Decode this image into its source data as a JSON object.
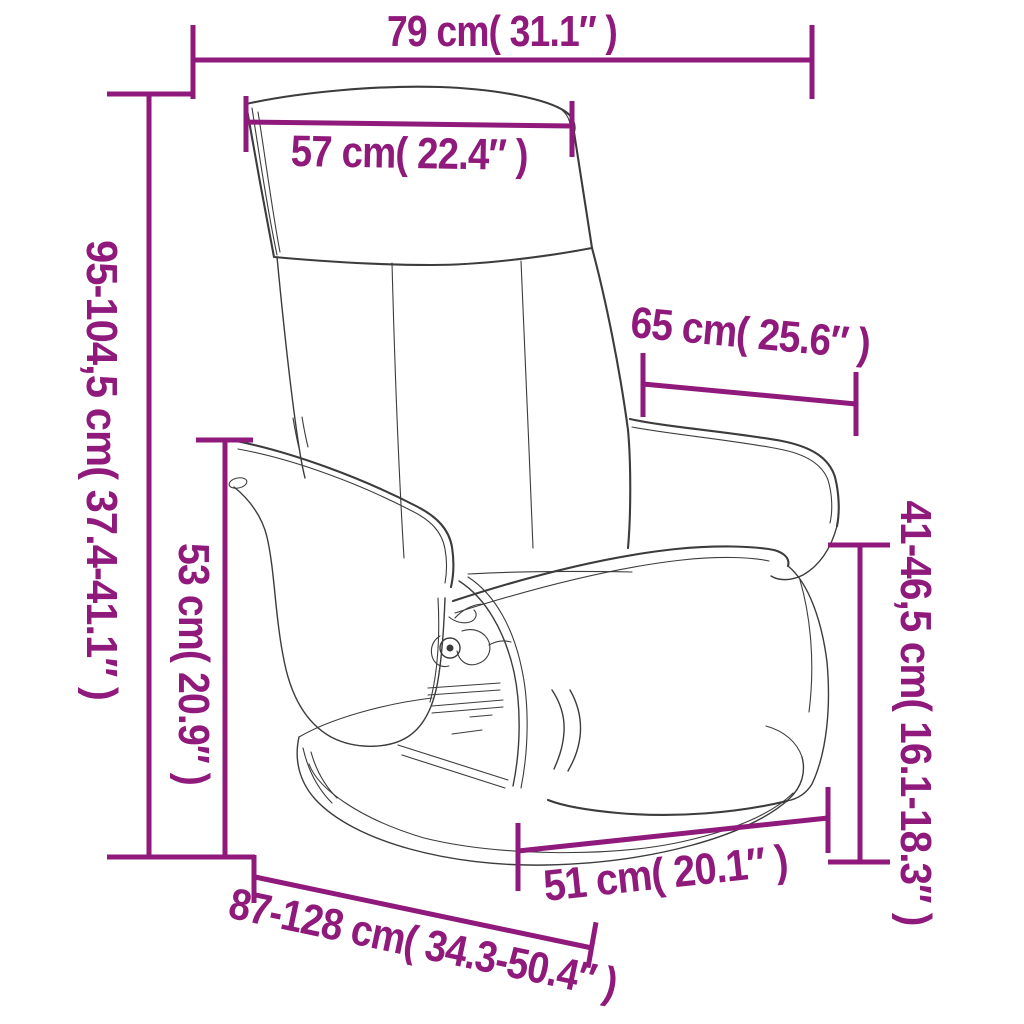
{
  "diagram": {
    "subject": "recliner chair with footrest dimension drawing",
    "background": "#ffffff"
  },
  "palette": {
    "dimension_color": "#8f1a7c",
    "drawing_color": "#3c3c3c"
  },
  "labels": {
    "top_width": "79 cm( 31.1″ )",
    "headrest_width": "57 cm( 22.4″ )",
    "height_range": "95-104,5 cm( 37.4-41.1″ )",
    "armrest_height": "53 cm( 20.9″ )",
    "backrest_depth": "65 cm( 25.6″ )",
    "seat_height_range": "41-46,5 cm( 16.1-18.3″ )",
    "seat_width": "51 cm( 20.1″ )",
    "depth_range": "87-128 cm( 34.3-50.4″ )"
  }
}
